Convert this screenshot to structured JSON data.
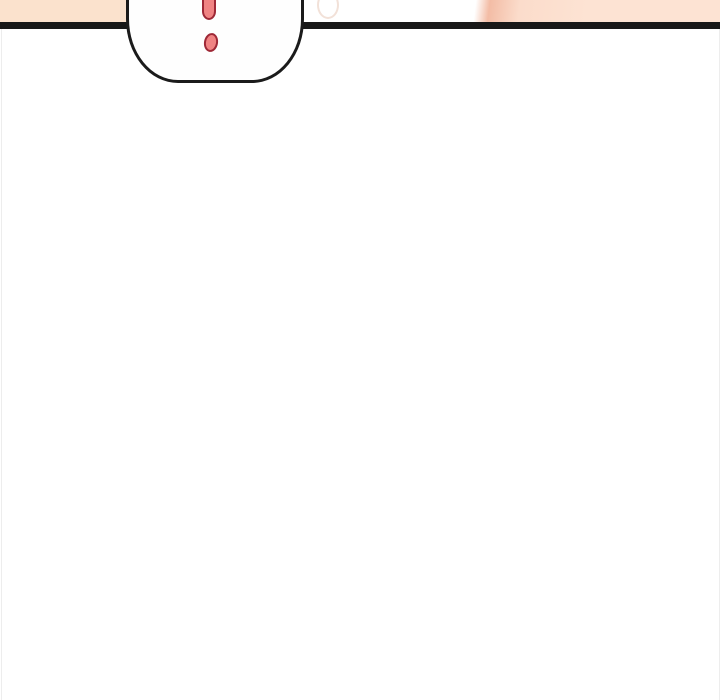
{
  "page": {
    "kind": "webtoon-comic-panel-bottom-edge",
    "speech_bubble": {
      "content_symbol": "!",
      "symbol_name": "exclamation-mark"
    }
  },
  "css_vars": {
    "page-bg": "#ffffff",
    "panel-line": "#181818",
    "bubble-fill": "#fefefe",
    "bubble-outline": "#1b1b1b",
    "excl-fill": "#f08383",
    "excl-outline": "#9e2836",
    "skin-left": "#fbe2cd",
    "skin-right-edge": "#f3bca5",
    "skin-right-mid": "#fbdccb",
    "skin-right-end": "#fde3d3",
    "faint-oval": "#f2e1d8",
    "page-edge": "#ededed"
  }
}
